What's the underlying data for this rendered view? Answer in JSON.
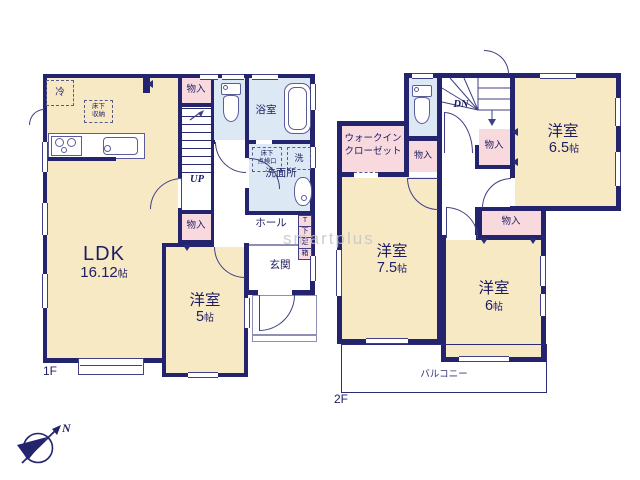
{
  "watermark": "smartplus",
  "compass": {
    "north": "N"
  },
  "colors": {
    "wall": "#23236e",
    "room": "#f8e9c5",
    "closet": "#f7d9de",
    "wet": "#dde8f5"
  },
  "floor1": {
    "label": "1F",
    "ldk": {
      "name": "LDK",
      "size": "16.12",
      "unit": "帖"
    },
    "western5": {
      "name": "洋室",
      "size": "5",
      "unit": "帖"
    },
    "bath": "浴室",
    "washroom": "洗面所",
    "hall": "ホール",
    "entrance": "玄関",
    "closet_top": "物入",
    "closet_mid": "物入",
    "stairs_label": "UP",
    "fridge": "冷",
    "underfloor_storage": [
      "床下",
      "収納"
    ],
    "inspection_hatch": [
      "床下",
      "点検口"
    ],
    "laundry": "洗",
    "shoe_box": [
      "T",
      "下",
      "足",
      "箱"
    ]
  },
  "floor2": {
    "label": "2F",
    "western65": {
      "name": "洋室",
      "size": "6.5",
      "unit": "帖"
    },
    "western75": {
      "name": "洋室",
      "size": "7.5",
      "unit": "帖"
    },
    "western6": {
      "name": "洋室",
      "size": "6",
      "unit": "帖"
    },
    "wic": [
      "ウォークイン",
      "クローゼット"
    ],
    "closet_a": "物入",
    "closet_b": "物入",
    "closet_c": "物入",
    "stairs_label": "DN",
    "balcony": "バルコニー"
  }
}
